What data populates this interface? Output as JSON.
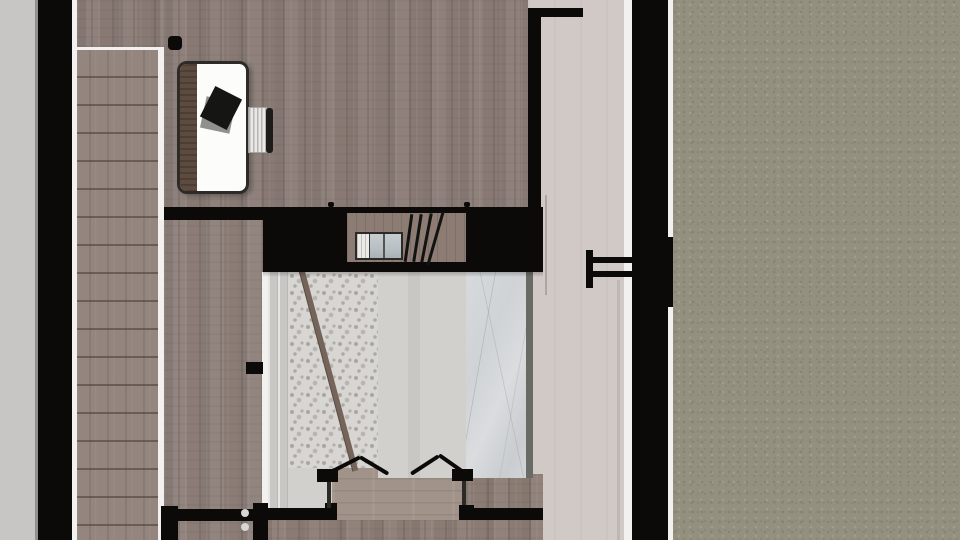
{
  "scene": {
    "type": "floor-plan-top-down-render",
    "objects": [
      "staircase",
      "stair-handrail",
      "desk",
      "desk-laptop",
      "office-chair",
      "built-in-appliance",
      "loft-ladder",
      "double-door-swing",
      "door-hardware-symbol",
      "wall-knobs",
      "pebble-floor",
      "marble-panel",
      "terrace-ground"
    ]
  },
  "colors": {
    "wall_black": "#0b0a09",
    "exterior_gray": "#c7c6c4",
    "exterior_edge": "#908f8d",
    "white_trim": "#f2f1ef",
    "stair_wood": "#94857e",
    "room_wood": "#8b7c76",
    "lower_room_wood": "#8e7f79",
    "bottom_room_wood": "#8d7e76",
    "threshold_wood": "#a2938a",
    "alcove_wood": "#8c7c74",
    "hall_floor": "#d1c9c6",
    "pebble_base": "#d8d6d2",
    "pebble_dot": "#a8a5a0",
    "plain_gray": "#d2d0cc",
    "marble_base": "#cfd3d6",
    "marble_edge_dark": "#696966",
    "rail_brown": "#75645a",
    "desk_border": "#2d2b28",
    "desk_white": "#fcfcfb",
    "desk_wood": "#5e4b3f",
    "laptop_black": "#151513",
    "laptop_gray": "#90908c",
    "chair_white": "#e9e8e6",
    "chair_stripe": "#b7b5b2",
    "chair_black": "#1c1c1a",
    "appliance_frame": "#2b2a28",
    "appliance_glass": "#b9c0c4",
    "appliance_white": "#eceae7",
    "knob_gray": "#d9d7d4",
    "terrace_base": "#93907f",
    "terrace_dark": "#858271",
    "terrace_light": "#a09d8c"
  }
}
